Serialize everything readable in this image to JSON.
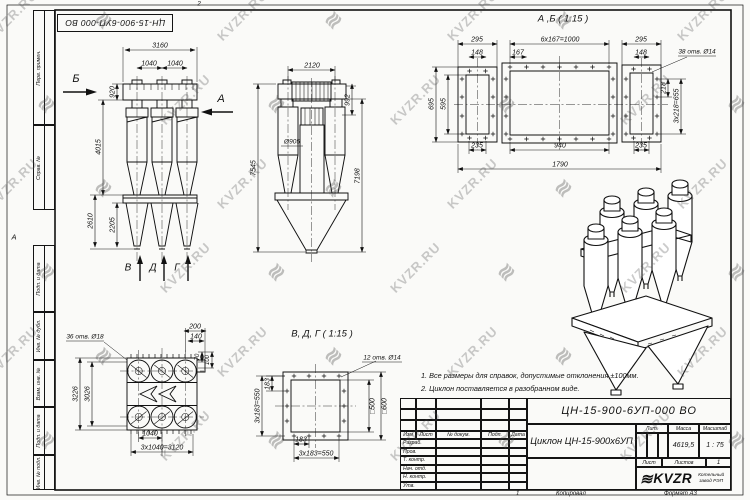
{
  "watermark": {
    "text": "KVZR.RU",
    "logo_glyph": "≋"
  },
  "sheet": {
    "top_designation": "ЦН-15-900-6УП-000 ВО",
    "margin_labels": [
      "Перв. примен.",
      "Справ. №",
      "Подп. и дата",
      "Инв. № дубл.",
      "Взам. инв. №",
      "Подп. и дата",
      "Инв. № подл."
    ],
    "footer": {
      "sheet_mark": "1",
      "copied_label": "Копировал",
      "format_label": "Формат А3"
    }
  },
  "notes": {
    "line1": "1. Все размеры для справок, допустимые отклонения ±100мм.",
    "line2": "2. Циклон поставляется в разобранном виде."
  },
  "title_block": {
    "designation": "ЦН-15-900-6УП-000 ВО",
    "name": "Циклон ЦН-15-900х6УП",
    "header_cells": [
      "Изм",
      "Лист",
      "№ докум.",
      "Подп.",
      "Дата"
    ],
    "rows": [
      "Разраб.",
      "Пров.",
      "Т. контр.",
      "Нач. отд.",
      "Н. контр.",
      "Утв."
    ],
    "lit_label": "Лит.",
    "mass_label": "Масса",
    "scale_label": "Масштаб",
    "mass_value": "4619,5",
    "scale_value": "1 : 75",
    "sheet_label": "Лист",
    "sheets_label": "Листов",
    "sheets_value": "1",
    "logo_text": "KVZR",
    "company": "Котельный завод РЭП"
  },
  "drawing_labels": [
    {
      "name": "zone-mark-top",
      "text": "2",
      "x": 199,
      "y": 4,
      "size": 6.5
    },
    {
      "name": "zone-mark-left",
      "text": "А",
      "x": 14,
      "y": 237,
      "size": 7.5
    },
    {
      "name": "front-dim-3160",
      "text": "3160",
      "x": 160,
      "y": 46
    },
    {
      "name": "front-dim-1040-a",
      "text": "1040",
      "x": 149,
      "y": 64
    },
    {
      "name": "front-dim-1040-b",
      "text": "1040",
      "x": 175,
      "y": 64
    },
    {
      "name": "front-dim-920",
      "text": "920",
      "x": 113,
      "y": 92,
      "rot": -90
    },
    {
      "name": "front-dim-4015",
      "text": "4015",
      "x": 99,
      "y": 147,
      "rot": -90
    },
    {
      "name": "front-dim-2610",
      "text": "2610",
      "x": 91,
      "y": 221,
      "rot": -90
    },
    {
      "name": "front-dim-2205",
      "text": "2205",
      "x": 113,
      "y": 225,
      "rot": -90
    },
    {
      "name": "front-arrow-letter-b",
      "text": "Б",
      "x": 76,
      "y": 79,
      "size": 11
    },
    {
      "name": "front-arrow-letter-a",
      "text": "А",
      "x": 221,
      "y": 99,
      "size": 11
    },
    {
      "name": "front-outlet-letter-v",
      "text": "В",
      "x": 128,
      "y": 268,
      "size": 10
    },
    {
      "name": "front-outlet-letter-d",
      "text": "Д",
      "x": 153,
      "y": 268,
      "size": 10
    },
    {
      "name": "front-outlet-letter-g",
      "text": "Г",
      "x": 177,
      "y": 268,
      "size": 10
    },
    {
      "name": "side-dim-2120",
      "text": "2120",
      "x": 312,
      "y": 66
    },
    {
      "name": "side-dim-992",
      "text": "992",
      "x": 348,
      "y": 100,
      "rot": -90
    },
    {
      "name": "side-dim-d905",
      "text": "Ø905",
      "x": 292,
      "y": 142,
      "size": 6.5
    },
    {
      "name": "side-dim-7545",
      "text": "7545",
      "x": 254,
      "y": 168,
      "rot": -90
    },
    {
      "name": "side-dim-7198",
      "text": "7198",
      "x": 358,
      "y": 176,
      "rot": -90
    },
    {
      "name": "section-ab-title",
      "text": "А ,Б ( 1:15 )",
      "x": 563,
      "y": 19,
      "size": 9.5
    },
    {
      "name": "sec-dim-295-l",
      "text": "295",
      "x": 477,
      "y": 40
    },
    {
      "name": "sec-dim-1000",
      "text": "6x167=1000",
      "x": 560,
      "y": 40
    },
    {
      "name": "sec-dim-295-r",
      "text": "295",
      "x": 641,
      "y": 40
    },
    {
      "name": "sec-dim-148-l",
      "text": "148",
      "x": 477,
      "y": 53
    },
    {
      "name": "sec-dim-167",
      "text": "167",
      "x": 518,
      "y": 53
    },
    {
      "name": "sec-dim-148-r",
      "text": "148",
      "x": 641,
      "y": 53
    },
    {
      "name": "sec-note-holes",
      "text": "38 отв. Ø14",
      "x": 697,
      "y": 52,
      "size": 6.5
    },
    {
      "name": "sec-dim-218",
      "text": "218",
      "x": 664,
      "y": 88,
      "rot": -90
    },
    {
      "name": "sec-dim-655",
      "text": "3x218=655",
      "x": 677,
      "y": 106,
      "rot": -90
    },
    {
      "name": "sec-dim-695",
      "text": "695",
      "x": 432,
      "y": 104,
      "rot": -90
    },
    {
      "name": "sec-dim-595",
      "text": "595",
      "x": 444,
      "y": 104,
      "rot": -90
    },
    {
      "name": "sec-dim-235-l",
      "text": "235",
      "x": 477,
      "y": 146
    },
    {
      "name": "sec-dim-940",
      "text": "940",
      "x": 560,
      "y": 146
    },
    {
      "name": "sec-dim-235-r",
      "text": "235",
      "x": 641,
      "y": 146
    },
    {
      "name": "sec-dim-1790",
      "text": "1790",
      "x": 560,
      "y": 165
    },
    {
      "name": "plan-note-holes",
      "text": "36 отв. Ø18",
      "x": 85,
      "y": 337,
      "size": 6.5
    },
    {
      "name": "plan-dim-200",
      "text": "200",
      "x": 195,
      "y": 327
    },
    {
      "name": "plan-dim-140",
      "text": "140",
      "x": 196,
      "y": 337
    },
    {
      "name": "plan-dim-70",
      "text": "70",
      "x": 198,
      "y": 357,
      "rot": -90,
      "size": 6
    },
    {
      "name": "plan-dim-100",
      "text": "100",
      "x": 208,
      "y": 360,
      "rot": -90,
      "size": 6
    },
    {
      "name": "plan-dim-3226",
      "text": "3226",
      "x": 76,
      "y": 394,
      "rot": -90
    },
    {
      "name": "plan-dim-3026",
      "text": "3026",
      "x": 88,
      "y": 394,
      "rot": -90
    },
    {
      "name": "plan-dim-1040",
      "text": "1040",
      "x": 150,
      "y": 434
    },
    {
      "name": "plan-dim-3120",
      "text": "3x1040=3120",
      "x": 162,
      "y": 448
    },
    {
      "name": "flange-title",
      "text": "В, Д, Г ( 1:15 )",
      "x": 322,
      "y": 334,
      "size": 9.5
    },
    {
      "name": "flange-note-holes",
      "text": "12 отв. Ø14",
      "x": 382,
      "y": 358,
      "size": 6.5
    },
    {
      "name": "flange-dim-183-l",
      "text": "183",
      "x": 268,
      "y": 384,
      "rot": -90
    },
    {
      "name": "flange-dim-550-l",
      "text": "3x183=550",
      "x": 258,
      "y": 406,
      "rot": -90
    },
    {
      "name": "flange-dim-500",
      "text": "□500",
      "x": 373,
      "y": 406,
      "rot": -90
    },
    {
      "name": "flange-dim-600",
      "text": "□600",
      "x": 385,
      "y": 406,
      "rot": -90
    },
    {
      "name": "flange-dim-183-b",
      "text": "183",
      "x": 301,
      "y": 440
    },
    {
      "name": "flange-dim-550-b",
      "text": "3x183=550",
      "x": 316,
      "y": 454
    }
  ]
}
